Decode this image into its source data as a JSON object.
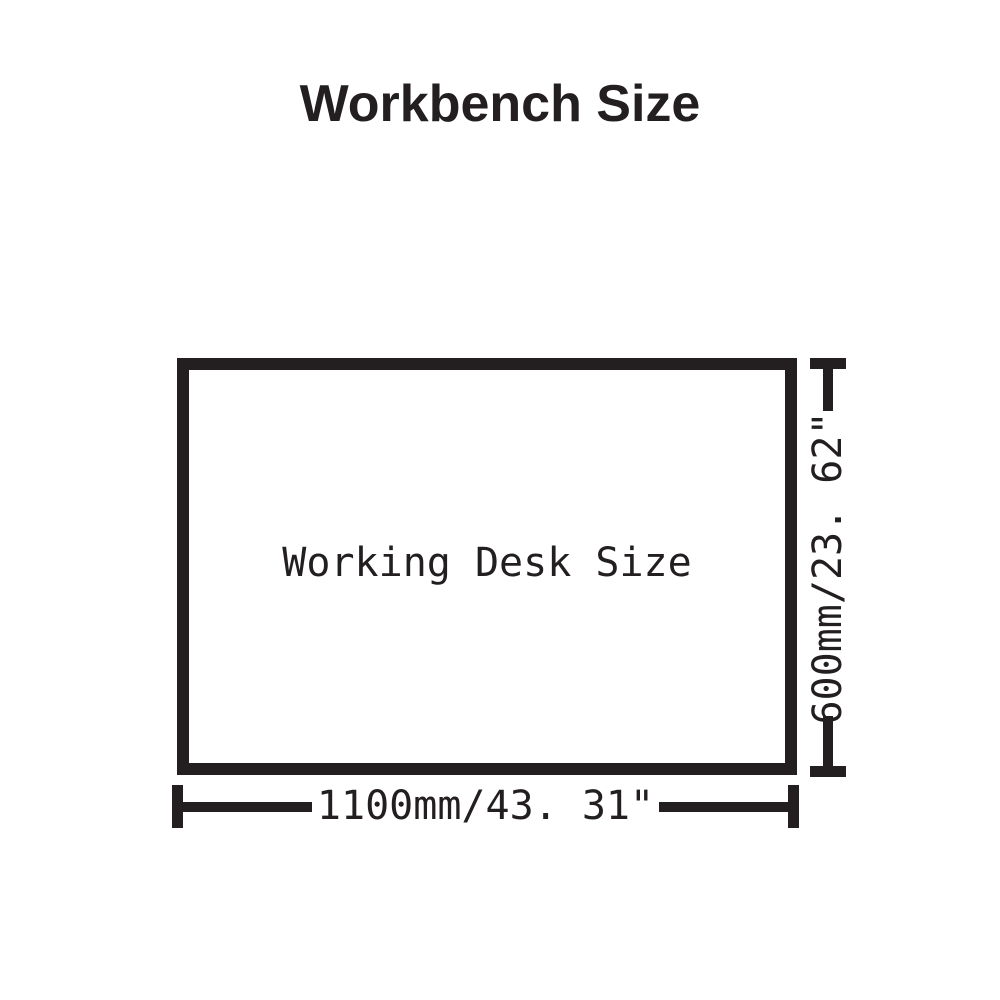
{
  "colors": {
    "ink": "#231f20",
    "background": "#ffffff"
  },
  "title": "Workbench Size",
  "diagram": {
    "desk_label": "Working Desk Size",
    "width_dimension": "1100mm/43. 31\"",
    "height_dimension": "600mm/23. 62\""
  }
}
